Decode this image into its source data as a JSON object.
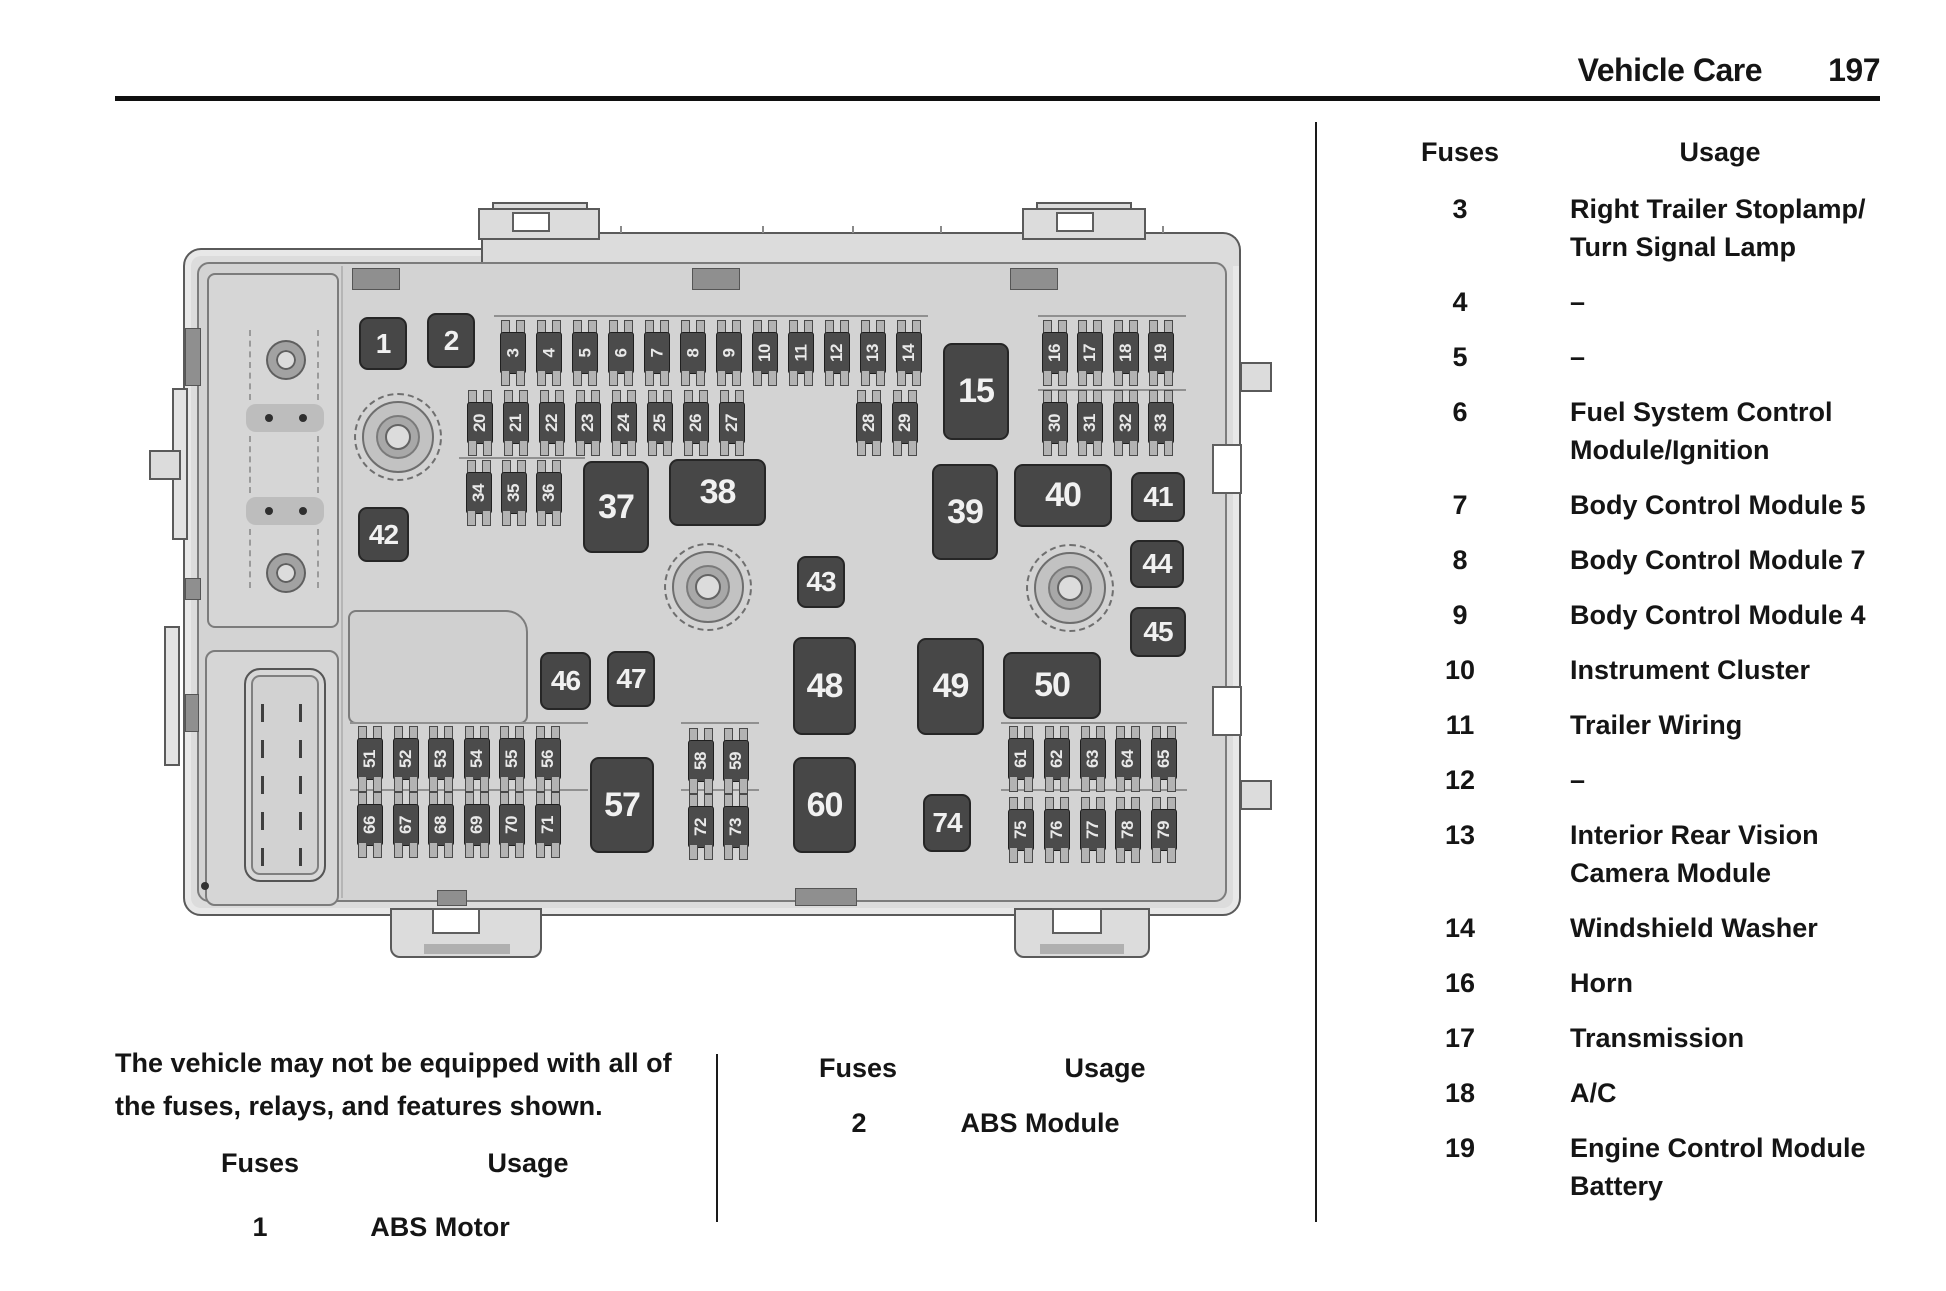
{
  "header": {
    "section_title": "Vehicle Care",
    "page_number": "197"
  },
  "note": {
    "line1": "The vehicle may not be equipped with all of",
    "line2": "the fuses, relays, and features shown."
  },
  "tables": {
    "left": {
      "fuses_header": "Fuses",
      "usage_header": "Usage",
      "rows": [
        {
          "fuse": "1",
          "usage": "ABS Motor"
        }
      ]
    },
    "middle": {
      "fuses_header": "Fuses",
      "usage_header": "Usage",
      "rows": [
        {
          "fuse": "2",
          "usage": "ABS Module"
        }
      ]
    },
    "right": {
      "fuses_header": "Fuses",
      "usage_header": "Usage",
      "rows": [
        {
          "fuse": "3",
          "lines": [
            "Right Trailer Stoplamp/",
            "Turn Signal Lamp"
          ]
        },
        {
          "fuse": "4",
          "lines": [
            "–"
          ]
        },
        {
          "fuse": "5",
          "lines": [
            "–"
          ]
        },
        {
          "fuse": "6",
          "lines": [
            "Fuel System Control",
            "Module/Ignition"
          ]
        },
        {
          "fuse": "7",
          "lines": [
            "Body Control Module 5"
          ]
        },
        {
          "fuse": "8",
          "lines": [
            "Body Control Module 7"
          ]
        },
        {
          "fuse": "9",
          "lines": [
            "Body Control Module 4"
          ]
        },
        {
          "fuse": "10",
          "lines": [
            "Instrument Cluster"
          ]
        },
        {
          "fuse": "11",
          "lines": [
            "Trailer Wiring"
          ]
        },
        {
          "fuse": "12",
          "lines": [
            "–"
          ]
        },
        {
          "fuse": "13",
          "lines": [
            "Interior Rear Vision",
            "Camera Module"
          ]
        },
        {
          "fuse": "14",
          "lines": [
            "Windshield Washer"
          ]
        },
        {
          "fuse": "16",
          "lines": [
            "Horn"
          ]
        },
        {
          "fuse": "17",
          "lines": [
            "Transmission"
          ]
        },
        {
          "fuse": "18",
          "lines": [
            "A/C"
          ]
        },
        {
          "fuse": "19",
          "lines": [
            "Engine Control Module",
            "Battery"
          ]
        }
      ]
    }
  },
  "diagram": {
    "relays": [
      "1",
      "2",
      "15",
      "37",
      "38",
      "39",
      "40",
      "41",
      "42",
      "43",
      "44",
      "45",
      "46",
      "47",
      "48",
      "49",
      "50",
      "57",
      "60",
      "74"
    ],
    "fuse_groups": [
      {
        "name": "row-3-14",
        "labels": [
          "3",
          "4",
          "5",
          "6",
          "7",
          "8",
          "9",
          "10",
          "11",
          "12",
          "13",
          "14"
        ]
      },
      {
        "name": "row-16-19",
        "labels": [
          "16",
          "17",
          "18",
          "19"
        ]
      },
      {
        "name": "row-20-27",
        "labels": [
          "20",
          "21",
          "22",
          "23",
          "24",
          "25",
          "26",
          "27"
        ]
      },
      {
        "name": "row-28-29",
        "labels": [
          "28",
          "29"
        ]
      },
      {
        "name": "row-30-33",
        "labels": [
          "30",
          "31",
          "32",
          "33"
        ]
      },
      {
        "name": "row-34-36",
        "labels": [
          "34",
          "35",
          "36"
        ]
      },
      {
        "name": "row-51-56",
        "labels": [
          "51",
          "52",
          "53",
          "54",
          "55",
          "56"
        ]
      },
      {
        "name": "row-58-59",
        "labels": [
          "58",
          "59"
        ]
      },
      {
        "name": "row-61-65",
        "labels": [
          "61",
          "62",
          "63",
          "64",
          "65"
        ]
      },
      {
        "name": "row-66-71",
        "labels": [
          "66",
          "67",
          "68",
          "69",
          "70",
          "71"
        ]
      },
      {
        "name": "row-72-73",
        "labels": [
          "72",
          "73"
        ]
      },
      {
        "name": "row-75-79",
        "labels": [
          "75",
          "76",
          "77",
          "78",
          "79"
        ]
      }
    ]
  },
  "colors": {
    "relay_fill": "#474747",
    "fuse_body": "#4b4b4b",
    "housing": "#dcdcdc",
    "panel": "#d3d3d3",
    "text": "#151515"
  }
}
